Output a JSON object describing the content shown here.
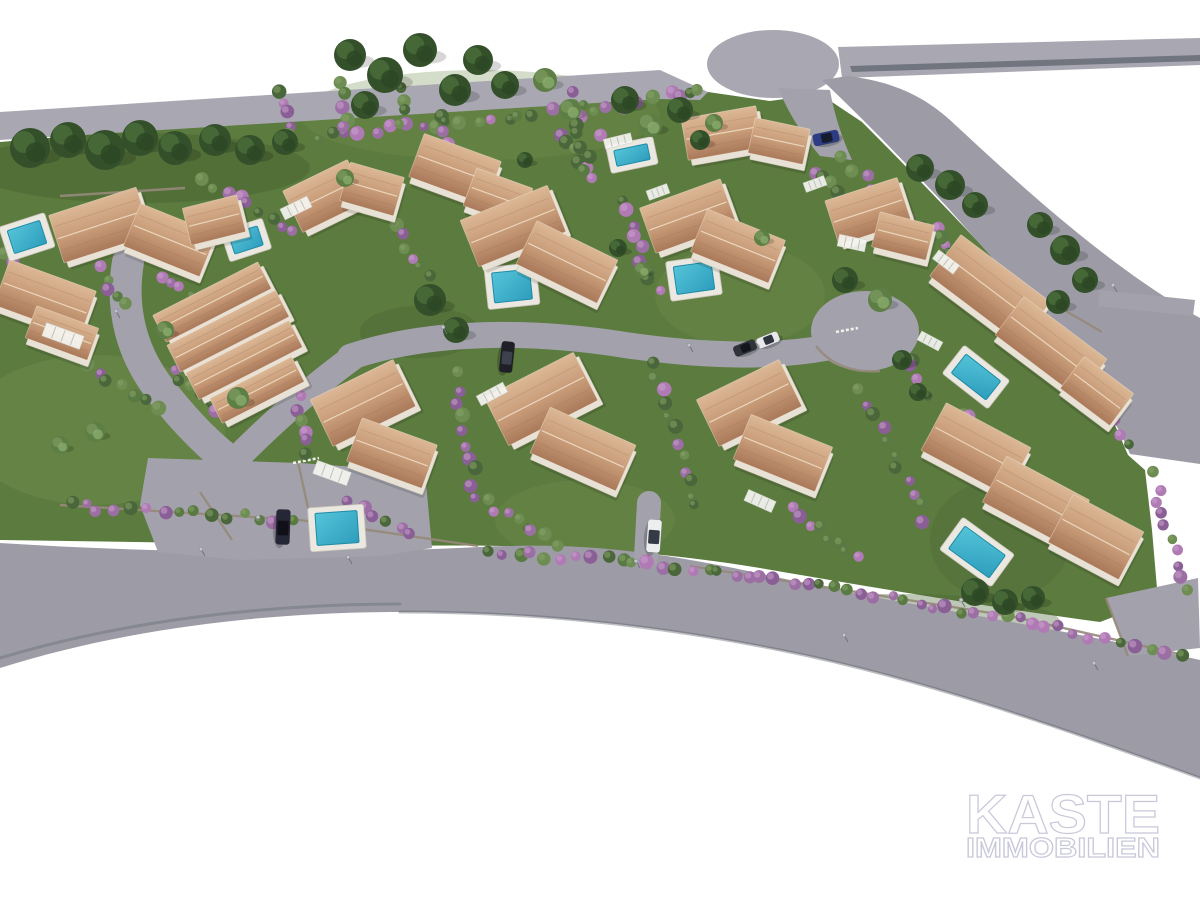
{
  "watermark": {
    "line1": "KASTE",
    "line2": "IMMOBILIEN"
  },
  "palette": {
    "background": "#ffffff",
    "lawn": "#5c7b3f",
    "lawn_light": "#6f8d4b",
    "lawn_dark": "#44602f",
    "road": "#9d9ca6",
    "road_light": "#a9a8b2",
    "road_mid": "#a3a2ac",
    "road_stripe": "#596069",
    "stone": "#96897a",
    "fence": "#f6f6f2",
    "roof_light": "#dcb896",
    "roof": "#c79a77",
    "roof_dark": "#a9795a",
    "roof_ridge": "#eedcc4",
    "wall": "#e8e2d6",
    "wall_edge": "#c9c2b4",
    "pool_deck": "#eae8e0",
    "pool_water_hi": "#55c4d8",
    "pool_water": "#2d9dbd",
    "pool_edge": "#1f8ba6",
    "hedge_purple": "#9b6fa3",
    "hedge_green": "#5a7a44",
    "tree": "#33502b",
    "tree_light": "#5d7f46",
    "lamp": "#c2c5cc",
    "watermark_fill": "#ffffff",
    "watermark_outline": "#c6c6d8"
  },
  "scene": {
    "grounds": [
      {
        "d": "M0,142 L310,116 L560,92 L665,84 L708,92 L770,101 L820,94 L862,122 C920,180 985,248 1046,315 C1086,362 1110,412 1128,455 L1145,470 L1152,530 L1158,600 L1100,622 C980,606 860,585 760,568 C640,548 520,544 400,546 L0,540 Z",
        "fill": "lawn"
      },
      {
        "ellipse": [
          95,
          430,
          130,
          75
        ],
        "fill": "lawn_light",
        "op": 0.45
      },
      {
        "ellipse": [
          480,
          115,
          180,
          45
        ],
        "fill": "lawn_light",
        "op": 0.3
      },
      {
        "ellipse": [
          740,
          295,
          85,
          50
        ],
        "fill": "lawn_light",
        "op": 0.4
      },
      {
        "ellipse": [
          585,
          520,
          90,
          40
        ],
        "fill": "lawn_light",
        "op": 0.3
      },
      {
        "ellipse": [
          140,
          168,
          170,
          35
        ],
        "fill": "lawn_dark",
        "op": 0.4
      },
      {
        "ellipse": [
          420,
          332,
          60,
          26
        ],
        "fill": "lawn_dark",
        "op": 0.35
      },
      {
        "ellipse": [
          900,
          622,
          160,
          28
        ],
        "fill": "lawn_dark",
        "op": 0.35
      },
      {
        "ellipse": [
          1000,
          540,
          70,
          60
        ],
        "fill": "lawn_dark",
        "op": 0.25
      }
    ],
    "roads": [
      {
        "d": "M0,112 L660,70 L708,92 L700,100 L660,99 L0,140 Z",
        "fill": "road_light"
      },
      {
        "ellipse": [
          773,
          64,
          66,
          34
        ],
        "fill": "road_light"
      },
      {
        "d": "M838,47 L1200,38 L1200,65 L842,78 Z",
        "fill": "road_light"
      },
      {
        "d": "M850,66 L1200,55 L1200,61 L852,72 Z",
        "fill": "road_stripe",
        "op": 0.7
      },
      {
        "d": "M778,88 C788,112 802,135 820,156 L852,160 C840,134 833,108 830,90 Z",
        "fill": "road_mid"
      },
      {
        "d": "M822,80 C862,118 905,162 948,208 C992,258 1042,312 1082,370 C1106,406 1122,434 1130,454 L1200,464 L1200,318 C1110,268 1020,185 950,120 C915,88 878,80 848,76 Z",
        "fill": "road"
      },
      {
        "d": "M0,543 C160,553 320,555 480,547 C600,541 680,556 790,580 C900,604 1050,626 1200,660 L1200,778 C1050,724 920,678 780,650 C640,622 520,612 400,612 C260,612 120,630 0,668 Z",
        "fill": "road"
      },
      {
        "d": "M148,458 L300,463 L425,472 L432,548 L380,556 L240,560 L158,552 L140,505 Z",
        "fill": "road_mid"
      },
      {
        "d": "M1106,598 L1198,578 L1200,648 L1128,656 Z",
        "fill": "road_mid"
      },
      {
        "d": "M1100,290 L1195,300 L1193,316 L1098,306 Z",
        "fill": "road_mid"
      },
      {
        "ellipse": [
          865,
          331,
          54,
          40
        ],
        "fill": "road_mid"
      },
      {
        "path": "M128,262 C120,310 132,355 162,392 C178,412 200,438 228,460",
        "sw": 32,
        "stroke": "road_mid"
      },
      {
        "path": "M352,358 C315,385 275,420 237,458",
        "sw": 26,
        "stroke": "road_mid"
      },
      {
        "path": "M350,357 C430,330 530,330 625,345 C700,356 770,358 825,348",
        "sw": 26,
        "stroke": "road_mid"
      },
      {
        "path": "M649,503 L646,557",
        "sw": 24,
        "stroke": "road_mid"
      },
      {
        "path": "M0,658 C120,622 260,604 400,604",
        "sw": 3,
        "stroke": "road_stripe",
        "op": 0.35
      },
      {
        "path": "M400,612 C520,612 640,622 780,650 C920,678 1050,724 1200,778",
        "sw": 3,
        "stroke": "road_stripe",
        "op": 0.4
      }
    ],
    "walls": [
      {
        "x1": 60,
        "y1": 196,
        "x2": 185,
        "y2": 188
      },
      {
        "x1": 60,
        "y1": 505,
        "x2": 300,
        "y2": 520
      },
      {
        "x1": 300,
        "y1": 520,
        "x2": 478,
        "y2": 546
      },
      {
        "x1": 690,
        "y1": 566,
        "x2": 1010,
        "y2": 616
      },
      {
        "x1": 1010,
        "y1": 616,
        "x2": 1188,
        "y2": 656
      },
      {
        "x1": 1040,
        "y1": 296,
        "x2": 1102,
        "y2": 332
      },
      {
        "x1": 298,
        "y1": 462,
        "x2": 308,
        "y2": 508
      },
      {
        "x1": 200,
        "y1": 492,
        "x2": 232,
        "y2": 540
      },
      {
        "x1": 1106,
        "y1": 598,
        "x2": 1128,
        "y2": 656
      },
      {
        "d": "M816,346 Q838,374 880,371"
      }
    ],
    "fences": [
      {
        "x1": 293,
        "y1": 463,
        "x2": 319,
        "y2": 458
      },
      {
        "x1": 836,
        "y1": 332,
        "x2": 858,
        "y2": 328
      }
    ],
    "hedges": [
      [
        310,
        138,
        660,
        100,
        24,
        0.5
      ],
      [
        668,
        96,
        706,
        92,
        4,
        0.4
      ],
      [
        835,
        155,
        1090,
        370,
        22,
        0.5
      ],
      [
        1090,
        370,
        1128,
        450,
        7,
        0.5
      ],
      [
        1150,
        468,
        1190,
        600,
        10,
        0.65
      ],
      [
        480,
        550,
        700,
        568,
        15,
        0.55
      ],
      [
        700,
        568,
        1010,
        618,
        22,
        0.65
      ],
      [
        1010,
        618,
        1188,
        656,
        12,
        0.6
      ],
      [
        60,
        505,
        300,
        520,
        15,
        0.35
      ],
      [
        622,
        195,
        658,
        300,
        9,
        0.5
      ],
      [
        452,
        368,
        478,
        505,
        10,
        0.5
      ],
      [
        650,
        358,
        698,
        515,
        12,
        0.6
      ],
      [
        858,
        385,
        928,
        525,
        11,
        0.5
      ],
      [
        556,
        128,
        596,
        184,
        6,
        0.5
      ],
      [
        930,
        225,
        990,
        298,
        7,
        0.45
      ],
      [
        200,
        180,
        300,
        232,
        9,
        0.5
      ],
      [
        60,
        348,
        160,
        410,
        9,
        0.45
      ],
      [
        390,
        222,
        432,
        282,
        6,
        0.55
      ],
      [
        282,
        88,
        290,
        140,
        5,
        0.35
      ],
      [
        340,
        80,
        348,
        132,
        5,
        0.35
      ],
      [
        396,
        74,
        404,
        126,
        5,
        0.35
      ],
      [
        443,
        108,
        452,
        168,
        6,
        0.4
      ],
      [
        572,
        90,
        588,
        172,
        8,
        0.45
      ],
      [
        600,
        135,
        650,
        168,
        5,
        0.5
      ],
      [
        170,
        368,
        240,
        428,
        8,
        0.45
      ],
      [
        95,
        262,
        130,
        310,
        5,
        0.7
      ],
      [
        160,
        272,
        195,
        300,
        4,
        0.7
      ],
      [
        790,
        505,
        860,
        560,
        8,
        0.6
      ],
      [
        480,
        500,
        560,
        545,
        8,
        0.5
      ],
      [
        298,
        390,
        310,
        460,
        6,
        0.5
      ],
      [
        815,
        168,
        840,
        195,
        4,
        0.55
      ],
      [
        878,
        228,
        920,
        258,
        5,
        0.45
      ],
      [
        0,
        250,
        30,
        290,
        5,
        0.5
      ],
      [
        345,
        500,
        420,
        540,
        6,
        0.45
      ],
      [
        908,
        352,
        925,
        405,
        5,
        0.4
      ],
      [
        964,
        408,
        990,
        440,
        4,
        0.5
      ]
    ],
    "pools": [
      {
        "x": 27,
        "y": 237,
        "w": 34,
        "h": 24,
        "r": -18
      },
      {
        "x": 246,
        "y": 240,
        "w": 30,
        "h": 20,
        "r": -18
      },
      {
        "x": 632,
        "y": 155,
        "w": 34,
        "h": 16,
        "r": -12
      },
      {
        "x": 512,
        "y": 286,
        "w": 38,
        "h": 30,
        "r": -6
      },
      {
        "x": 694,
        "y": 278,
        "w": 38,
        "h": 28,
        "r": -8
      },
      {
        "x": 976,
        "y": 377,
        "w": 44,
        "h": 24,
        "r": 38
      },
      {
        "x": 977,
        "y": 552,
        "w": 50,
        "h": 28,
        "r": 36
      },
      {
        "x": 337,
        "y": 528,
        "w": 42,
        "h": 32,
        "r": -4
      }
    ],
    "houses": [
      {
        "name": "villa-1",
        "parts": [
          [
            100,
            225,
            92,
            50,
            -18
          ],
          [
            170,
            240,
            82,
            46,
            22
          ],
          [
            214,
            220,
            56,
            38,
            -14
          ]
        ]
      },
      {
        "name": "villa-2",
        "parts": [
          [
            45,
            298,
            92,
            48,
            20
          ],
          [
            62,
            333,
            66,
            34,
            20
          ]
        ]
      },
      {
        "name": "villa-3",
        "parts": [
          [
            212,
            302,
            118,
            30,
            -27
          ],
          [
            228,
            331,
            122,
            30,
            -27
          ],
          [
            244,
            360,
            116,
            30,
            -27
          ],
          [
            257,
            390,
            92,
            28,
            -27
          ]
        ]
      },
      {
        "name": "villa-4",
        "parts": [
          [
            325,
            196,
            72,
            46,
            -26
          ],
          [
            372,
            189,
            56,
            40,
            16
          ]
        ]
      },
      {
        "name": "villa-5",
        "parts": [
          [
            455,
            169,
            82,
            46,
            20
          ],
          [
            498,
            197,
            60,
            40,
            20
          ]
        ]
      },
      {
        "name": "villa-6",
        "parts": [
          [
            722,
            133,
            76,
            42,
            -10
          ],
          [
            779,
            141,
            56,
            36,
            12
          ]
        ]
      },
      {
        "name": "villa-7",
        "parts": [
          [
            513,
            226,
            94,
            50,
            -22
          ],
          [
            567,
            262,
            90,
            48,
            26
          ]
        ]
      },
      {
        "name": "villa-8",
        "parts": [
          [
            688,
            216,
            86,
            48,
            -20
          ],
          [
            738,
            246,
            84,
            46,
            22
          ]
        ]
      },
      {
        "name": "villa-9",
        "parts": [
          [
            868,
            211,
            76,
            46,
            -18
          ],
          [
            903,
            236,
            56,
            36,
            14
          ]
        ]
      },
      {
        "name": "villa-10",
        "parts": [
          [
            990,
            289,
            112,
            52,
            37
          ],
          [
            1051,
            347,
            104,
            48,
            37
          ],
          [
            1097,
            391,
            62,
            40,
            37
          ]
        ]
      },
      {
        "name": "villa-11",
        "parts": [
          [
            976,
            449,
            96,
            54,
            28
          ],
          [
            1036,
            501,
            94,
            52,
            28
          ],
          [
            1096,
            537,
            80,
            54,
            28
          ]
        ]
      },
      {
        "name": "villa-12",
        "parts": [
          [
            749,
            403,
            92,
            52,
            -26
          ],
          [
            783,
            453,
            88,
            48,
            22
          ]
        ]
      },
      {
        "name": "villa-13",
        "parts": [
          [
            541,
            399,
            100,
            54,
            -27
          ],
          [
            583,
            449,
            94,
            50,
            24
          ]
        ]
      },
      {
        "name": "villa-14",
        "parts": [
          [
            363,
            403,
            92,
            52,
            -26
          ],
          [
            392,
            453,
            80,
            46,
            20
          ]
        ]
      }
    ],
    "pergolas": [
      [
        63,
        336,
        40,
        14,
        20
      ],
      [
        296,
        208,
        30,
        12,
        -26
      ],
      [
        852,
        243,
        28,
        12,
        12
      ],
      [
        332,
        473,
        36,
        14,
        20
      ],
      [
        492,
        394,
        30,
        11,
        -28
      ],
      [
        760,
        501,
        30,
        12,
        24
      ],
      [
        618,
        141,
        28,
        10,
        -14
      ],
      [
        946,
        262,
        26,
        11,
        37
      ],
      [
        930,
        341,
        24,
        10,
        28
      ],
      [
        815,
        184,
        22,
        10,
        -20
      ],
      [
        658,
        192,
        22,
        10,
        -20
      ]
    ],
    "trees": [
      [
        30,
        148,
        20
      ],
      [
        68,
        140,
        18
      ],
      [
        105,
        150,
        20
      ],
      [
        140,
        138,
        18
      ],
      [
        175,
        148,
        17
      ],
      [
        215,
        140,
        16
      ],
      [
        250,
        150,
        15
      ],
      [
        285,
        142,
        13
      ],
      [
        350,
        55,
        16
      ],
      [
        385,
        75,
        18
      ],
      [
        420,
        50,
        17
      ],
      [
        455,
        90,
        16
      ],
      [
        478,
        60,
        15
      ],
      [
        505,
        85,
        14
      ],
      [
        365,
        105,
        14
      ],
      [
        545,
        80,
        12,
        1
      ],
      [
        570,
        110,
        11,
        1
      ],
      [
        625,
        100,
        14
      ],
      [
        650,
        125,
        12,
        1
      ],
      [
        680,
        110,
        13
      ],
      [
        700,
        140,
        10
      ],
      [
        714,
        123,
        9,
        1
      ],
      [
        920,
        168,
        14
      ],
      [
        950,
        185,
        15
      ],
      [
        975,
        205,
        13
      ],
      [
        1040,
        225,
        13
      ],
      [
        1065,
        250,
        15
      ],
      [
        1085,
        280,
        13
      ],
      [
        1058,
        302,
        12
      ],
      [
        430,
        300,
        16
      ],
      [
        456,
        330,
        13
      ],
      [
        845,
        280,
        13
      ],
      [
        880,
        300,
        12,
        1
      ],
      [
        902,
        360,
        10
      ],
      [
        918,
        392,
        9
      ],
      [
        975,
        592,
        14
      ],
      [
        1005,
        602,
        13
      ],
      [
        1033,
        598,
        12
      ],
      [
        238,
        398,
        11,
        1
      ],
      [
        165,
        330,
        9,
        1
      ],
      [
        95,
        432,
        10,
        1
      ],
      [
        60,
        445,
        9,
        1
      ],
      [
        525,
        160,
        8
      ],
      [
        618,
        248,
        9
      ],
      [
        642,
        270,
        8,
        1
      ],
      [
        345,
        178,
        9,
        1
      ],
      [
        762,
        238,
        8,
        1
      ]
    ],
    "cars": [
      {
        "x": 826,
        "y": 138,
        "l": 26,
        "w": 12,
        "rot": -12,
        "body": "#2c3d85",
        "glass": "#161c2e"
      },
      {
        "x": 768,
        "y": 340,
        "l": 23,
        "w": 11,
        "rot": -22,
        "body": "#e8e8ec",
        "glass": "#2f333d"
      },
      {
        "x": 745,
        "y": 348,
        "l": 23,
        "w": 11,
        "rot": -22,
        "body": "#30323c",
        "glass": "#14161c"
      },
      {
        "x": 507,
        "y": 357,
        "l": 31,
        "w": 13,
        "rot": 96,
        "body": "#1f2027",
        "glass": "#3c414d"
      },
      {
        "x": 283,
        "y": 527,
        "l": 35,
        "w": 14,
        "rot": 92,
        "body": "#262736",
        "glass": "#101018"
      },
      {
        "x": 654,
        "y": 536,
        "l": 33,
        "w": 14,
        "rot": 94,
        "body": "#edeef0",
        "glass": "#343a46"
      }
    ],
    "lamps": [
      [
        262,
        524
      ],
      [
        120,
        318
      ],
      [
        447,
        334
      ],
      [
        693,
        352
      ],
      [
        848,
        642
      ],
      [
        1098,
        670
      ],
      [
        640,
        568
      ],
      [
        205,
        556
      ],
      [
        1117,
        292
      ],
      [
        965,
        607
      ],
      [
        352,
        564
      ]
    ]
  }
}
